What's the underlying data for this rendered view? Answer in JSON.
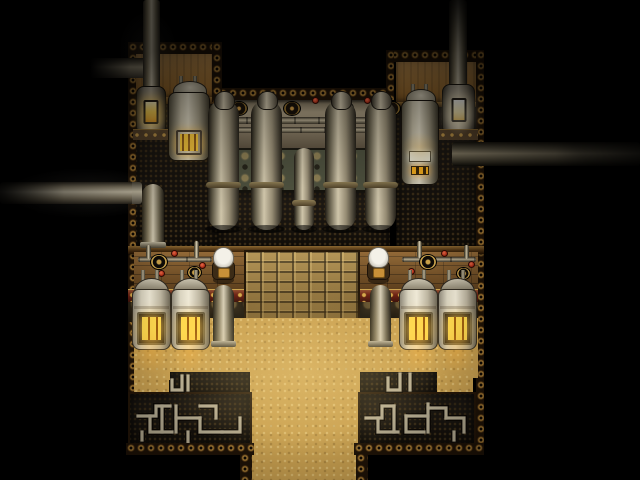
{
  "viewport": {
    "width": 640,
    "height": 480,
    "visible_text": "none"
  },
  "palette": {
    "black": "#000000",
    "sand": "#c9a050",
    "tan": "#b08040",
    "rivetBg": "#1f1307",
    "rivetAu": "#c09040",
    "mesh": "#15100a",
    "meshDot": "#3c2e18",
    "red": "#6e2114",
    "ornateG": "#4c4f3d",
    "ornateGHi": "#8a7c52",
    "bronze": "#352b1b",
    "bronzeHi": "#6a5733",
    "plank": "#7d5527",
    "crate": "#a08044",
    "amber": "#ffcf3a"
  },
  "scene": {
    "entities": [
      {
        "id": "rivet-top-left-block",
        "type": "rivets",
        "x": 128,
        "y": 42,
        "w": 94,
        "h": 12,
        "interactable": false
      },
      {
        "id": "wall-left-block",
        "type": "tanwall",
        "x": 134,
        "y": 54,
        "w": 84,
        "h": 46,
        "interactable": false
      },
      {
        "id": "trim-left-block",
        "type": "trim",
        "x": 134,
        "y": 97,
        "w": 84,
        "h": 7,
        "interactable": false
      },
      {
        "id": "meshfloor-left-block",
        "type": "mesh",
        "x": 134,
        "y": 104,
        "w": 84,
        "h": 148,
        "interactable": false
      },
      {
        "id": "rivet-top-mid-block",
        "type": "rivets",
        "x": 218,
        "y": 88,
        "w": 172,
        "h": 12,
        "interactable": false
      },
      {
        "id": "machine-wall",
        "type": "machinewall",
        "x": 218,
        "y": 100,
        "w": 172,
        "h": 48,
        "interactable": false
      },
      {
        "id": "ornate-band-green",
        "type": "ornateG",
        "x": 218,
        "y": 148,
        "w": 172,
        "h": 44,
        "interactable": false
      },
      {
        "id": "meshfloor-mid-block",
        "type": "mesh",
        "x": 218,
        "y": 192,
        "w": 172,
        "h": 60,
        "interactable": false
      },
      {
        "id": "rivet-top-right-block",
        "type": "rivets",
        "x": 390,
        "y": 50,
        "w": 94,
        "h": 12,
        "interactable": false
      },
      {
        "id": "wall-right-block",
        "type": "tanwall",
        "x": 396,
        "y": 62,
        "w": 82,
        "h": 42,
        "interactable": false
      },
      {
        "id": "trim-right-block",
        "type": "trim",
        "x": 396,
        "y": 102,
        "w": 82,
        "h": 5,
        "interactable": false
      },
      {
        "id": "meshfloor-right-block",
        "type": "mesh",
        "x": 396,
        "y": 107,
        "w": 82,
        "h": 145,
        "interactable": false
      },
      {
        "id": "rivet-col-left-wall",
        "type": "rivets",
        "x": 128,
        "y": 42,
        "w": 8,
        "h": 413,
        "interactable": false
      },
      {
        "id": "rivet-col-right-wall",
        "type": "rivets",
        "x": 476,
        "y": 50,
        "w": 8,
        "h": 405,
        "interactable": false
      },
      {
        "id": "rivet-col-notch-left",
        "type": "rivets",
        "x": 212,
        "y": 42,
        "w": 10,
        "h": 60,
        "interactable": false
      },
      {
        "id": "rivet-col-notch-right",
        "type": "rivets",
        "x": 386,
        "y": 50,
        "w": 8,
        "h": 50,
        "interactable": false
      },
      {
        "id": "beam-middle",
        "type": "beam",
        "x": 128,
        "y": 246,
        "w": 356,
        "h": 8,
        "interactable": false
      },
      {
        "id": "plank-floor-left",
        "type": "plank",
        "x": 134,
        "y": 252,
        "w": 110,
        "h": 40,
        "interactable": false
      },
      {
        "id": "plank-floor-right",
        "type": "plank",
        "x": 360,
        "y": 252,
        "w": 118,
        "h": 40,
        "interactable": false
      },
      {
        "id": "crate-grid",
        "type": "crate",
        "x": 244,
        "y": 250,
        "w": 116,
        "h": 73,
        "interactable": false
      },
      {
        "id": "ornate-band-red-left",
        "type": "bandRed",
        "x": 128,
        "y": 289,
        "w": 116,
        "h": 14,
        "interactable": false
      },
      {
        "id": "ornate-band-red-right",
        "type": "bandRed",
        "x": 360,
        "y": 289,
        "w": 118,
        "h": 14,
        "interactable": false
      },
      {
        "id": "ornate-band-bronze-left",
        "type": "bandBronze",
        "x": 128,
        "y": 302,
        "w": 116,
        "h": 20,
        "interactable": false
      },
      {
        "id": "ornate-band-bronze-right",
        "type": "bandBronze",
        "x": 360,
        "y": 302,
        "w": 118,
        "h": 20,
        "interactable": false
      },
      {
        "id": "sand-floor-main",
        "type": "sand",
        "x": 134,
        "y": 318,
        "w": 344,
        "h": 60,
        "interactable": true
      },
      {
        "id": "sand-corridor-bottom",
        "type": "sand",
        "x": 248,
        "y": 375,
        "w": 112,
        "h": 105,
        "interactable": true
      },
      {
        "id": "sand-inset-left",
        "type": "sand",
        "x": 134,
        "y": 375,
        "w": 37,
        "h": 25,
        "interactable": true
      },
      {
        "id": "sand-inset-right",
        "type": "sand",
        "x": 437,
        "y": 375,
        "w": 36,
        "h": 25,
        "interactable": true
      },
      {
        "id": "pipe-maze-left-upper",
        "type": "mesh",
        "x": 170,
        "y": 372,
        "w": 80,
        "h": 22,
        "interactable": false
      },
      {
        "id": "pipe-maze-right-upper",
        "type": "mesh",
        "x": 360,
        "y": 372,
        "w": 77,
        "h": 22,
        "interactable": false
      },
      {
        "id": "pipe-maze-left",
        "type": "maze",
        "x": 128,
        "y": 392,
        "w": 124,
        "h": 60,
        "interactable": false,
        "paths": [
          "M10,24 h18 v-10 h14",
          "M22,24 v16 h22",
          "M34,40 v-26",
          "M48,14 v26",
          "M48,26 h24",
          "M72,26 v14 h22",
          "M72,14 h16 v12",
          "M94,40 h18 v-14",
          "M60,40 v10",
          "M14,40 v8",
          "M44,-12 v10 h10 v-14",
          "M60,-16 v14"
        ]
      },
      {
        "id": "pipe-maze-right",
        "type": "maze",
        "x": 358,
        "y": 392,
        "w": 118,
        "h": 60,
        "interactable": false,
        "paths": [
          "M8,26 h16 v-12 h12",
          "M20,26 v14 h20",
          "M36,14 v26",
          "M48,24 h22",
          "M48,24 v16 h18",
          "M70,12 v28",
          "M70,16 h18 v10",
          "M88,26 h18 v14",
          "M96,40 v8",
          "M30,-14 v12 h12 v-16",
          "M52,-18 v16"
        ]
      },
      {
        "id": "rivet-row-bottom-left",
        "type": "rivets",
        "x": 126,
        "y": 443,
        "w": 128,
        "h": 12,
        "interactable": false
      },
      {
        "id": "rivet-row-bottom-right",
        "type": "rivets",
        "x": 354,
        "y": 443,
        "w": 130,
        "h": 12,
        "interactable": false
      },
      {
        "id": "rivet-col-corridor-left",
        "type": "rivets",
        "x": 240,
        "y": 453,
        "w": 12,
        "h": 27,
        "interactable": false
      },
      {
        "id": "rivet-col-corridor-right",
        "type": "rivets",
        "x": 356,
        "y": 453,
        "w": 12,
        "h": 27,
        "interactable": false
      },
      {
        "id": "steam-pipe-stub-top-left",
        "type": "pipeV",
        "variant": "stub-left",
        "x": 90,
        "y": 58,
        "w": 58,
        "h": 20,
        "interactable": false
      },
      {
        "id": "steam-pipe-vertical-top-left",
        "type": "pipeV",
        "x": 143,
        "y": 0,
        "w": 17,
        "h": 96,
        "interactable": false
      },
      {
        "id": "chimney-top-right",
        "type": "pipeV",
        "variant": "fade-top",
        "x": 449,
        "y": 0,
        "w": 18,
        "h": 98,
        "interactable": false
      },
      {
        "id": "steam-pipe-exterior-left",
        "type": "pipeH",
        "variant": "ext-left",
        "x": 0,
        "y": 182,
        "w": 142,
        "h": 22,
        "interactable": false
      },
      {
        "id": "steam-pipe-exterior-right",
        "type": "pipeH",
        "variant": "ext-right",
        "x": 452,
        "y": 142,
        "w": 188,
        "h": 24,
        "interactable": false
      },
      {
        "id": "furnace-top-left",
        "type": "furnace",
        "variant": "amber",
        "x": 136,
        "y": 86,
        "w": 30,
        "h": 54,
        "interactable": true
      },
      {
        "id": "tank-top-left",
        "type": "tank",
        "variant": "bars",
        "x": 168,
        "y": 76,
        "w": 42,
        "h": 88,
        "interactable": true
      },
      {
        "id": "capsule-under-tank-left",
        "type": "capsule",
        "x": 142,
        "y": 184,
        "w": 22,
        "h": 64,
        "interactable": false
      },
      {
        "id": "pipe-rail-upper",
        "type": "rail",
        "x": 222,
        "y": 117,
        "w": 164,
        "h": 7,
        "interactable": false
      },
      {
        "id": "pipe-rail-lower",
        "type": "rail",
        "x": 228,
        "y": 127,
        "w": 158,
        "h": 6,
        "interactable": false
      },
      {
        "id": "gauge-1",
        "type": "gauge",
        "x": 230,
        "y": 101,
        "w": 18,
        "h": 15,
        "interactable": true
      },
      {
        "id": "gauge-2",
        "type": "gauge",
        "x": 283,
        "y": 101,
        "w": 18,
        "h": 15,
        "interactable": true
      },
      {
        "id": "gauge-3",
        "type": "gauge",
        "x": 336,
        "y": 101,
        "w": 18,
        "h": 15,
        "interactable": true
      },
      {
        "id": "gauge-4",
        "type": "gauge",
        "x": 383,
        "y": 101,
        "w": 18,
        "h": 15,
        "interactable": true
      },
      {
        "id": "valve-wall-1",
        "type": "valve",
        "x": 259,
        "y": 97,
        "w": 7,
        "h": 7,
        "interactable": true
      },
      {
        "id": "valve-wall-2",
        "type": "valve",
        "x": 312,
        "y": 97,
        "w": 7,
        "h": 7,
        "interactable": true
      },
      {
        "id": "valve-wall-3",
        "type": "valve",
        "x": 364,
        "y": 97,
        "w": 7,
        "h": 7,
        "interactable": true
      },
      {
        "id": "valve-wall-4",
        "type": "valve",
        "x": 268,
        "y": 126,
        "w": 7,
        "h": 7,
        "interactable": true
      },
      {
        "id": "valve-wall-5",
        "type": "valve",
        "x": 340,
        "y": 126,
        "w": 7,
        "h": 7,
        "interactable": true
      },
      {
        "id": "distill-column-1",
        "type": "column",
        "x": 208,
        "y": 100,
        "w": 31,
        "h": 130,
        "interactable": false
      },
      {
        "id": "distill-column-2",
        "type": "column",
        "x": 251,
        "y": 100,
        "w": 31,
        "h": 130,
        "interactable": false
      },
      {
        "id": "distill-column-short",
        "type": "column",
        "variant": "short",
        "x": 294,
        "y": 148,
        "w": 20,
        "h": 82,
        "interactable": false
      },
      {
        "id": "distill-column-3",
        "type": "column",
        "x": 325,
        "y": 100,
        "w": 31,
        "h": 130,
        "interactable": false
      },
      {
        "id": "distill-column-4",
        "type": "column",
        "x": 365,
        "y": 100,
        "w": 31,
        "h": 130,
        "interactable": false
      },
      {
        "id": "furnace-top-right",
        "type": "furnace",
        "variant": "white",
        "x": 442,
        "y": 84,
        "w": 33,
        "h": 56,
        "interactable": true
      },
      {
        "id": "tank-top-right",
        "type": "tank",
        "variant": "gauge",
        "x": 401,
        "y": 84,
        "w": 38,
        "h": 104,
        "interactable": true
      },
      {
        "id": "bench-pipe-left-h",
        "type": "rail",
        "x": 138,
        "y": 257,
        "w": 74,
        "h": 5,
        "interactable": false
      },
      {
        "id": "bench-pipe-left-v1",
        "type": "pipeV",
        "x": 146,
        "y": 245,
        "w": 5,
        "h": 14,
        "interactable": false
      },
      {
        "id": "bench-pipe-left-v2",
        "type": "pipeV",
        "x": 194,
        "y": 241,
        "w": 5,
        "h": 17,
        "interactable": false
      },
      {
        "id": "burner-left-1",
        "type": "burner",
        "x": 150,
        "y": 254,
        "w": 18,
        "h": 16,
        "interactable": true
      },
      {
        "id": "burner-left-2",
        "type": "burner",
        "x": 187,
        "y": 266,
        "w": 15,
        "h": 13,
        "interactable": true
      },
      {
        "id": "valve-bench-left-1",
        "type": "valve",
        "x": 171,
        "y": 250,
        "w": 7,
        "h": 7,
        "interactable": true
      },
      {
        "id": "valve-bench-left-2",
        "type": "valve",
        "x": 158,
        "y": 270,
        "w": 7,
        "h": 7,
        "interactable": true
      },
      {
        "id": "valve-bench-left-3",
        "type": "valve",
        "x": 199,
        "y": 262,
        "w": 7,
        "h": 7,
        "interactable": true
      },
      {
        "id": "bench-pipe-right-h",
        "type": "rail",
        "x": 402,
        "y": 257,
        "w": 74,
        "h": 5,
        "interactable": false
      },
      {
        "id": "bench-pipe-right-v1",
        "type": "pipeV",
        "x": 464,
        "y": 245,
        "w": 5,
        "h": 14,
        "interactable": false
      },
      {
        "id": "bench-pipe-right-v2",
        "type": "pipeV",
        "x": 417,
        "y": 241,
        "w": 5,
        "h": 17,
        "interactable": false
      },
      {
        "id": "burner-right-1",
        "type": "burner",
        "x": 419,
        "y": 254,
        "w": 18,
        "h": 16,
        "interactable": true
      },
      {
        "id": "burner-right-2",
        "type": "burner",
        "x": 456,
        "y": 267,
        "w": 15,
        "h": 13,
        "interactable": true
      },
      {
        "id": "valve-bench-right-1",
        "type": "valve",
        "x": 441,
        "y": 250,
        "w": 7,
        "h": 7,
        "interactable": true
      },
      {
        "id": "valve-bench-right-2",
        "type": "valve",
        "x": 408,
        "y": 268,
        "w": 7,
        "h": 7,
        "interactable": true
      },
      {
        "id": "valve-bench-right-3",
        "type": "valve",
        "x": 468,
        "y": 261,
        "w": 7,
        "h": 7,
        "interactable": true
      },
      {
        "id": "boiler-1",
        "type": "boiler",
        "x": 132,
        "y": 270,
        "w": 39,
        "h": 82,
        "interactable": true
      },
      {
        "id": "boiler-2",
        "type": "boiler",
        "x": 171,
        "y": 270,
        "w": 39,
        "h": 82,
        "interactable": true
      },
      {
        "id": "boiler-3",
        "type": "boiler",
        "x": 399,
        "y": 270,
        "w": 39,
        "h": 82,
        "interactable": true
      },
      {
        "id": "boiler-4",
        "type": "boiler",
        "x": 438,
        "y": 270,
        "w": 39,
        "h": 82,
        "interactable": true
      },
      {
        "id": "floor-pipe-left",
        "type": "capsule",
        "x": 213,
        "y": 285,
        "w": 21,
        "h": 62,
        "interactable": false
      },
      {
        "id": "floor-pipe-right",
        "type": "capsule",
        "x": 370,
        "y": 285,
        "w": 21,
        "h": 62,
        "interactable": false
      },
      {
        "id": "npc-worker-left",
        "type": "npc",
        "x": 210,
        "y": 247,
        "w": 27,
        "h": 37,
        "interactable": true
      },
      {
        "id": "npc-worker-right",
        "type": "npc",
        "x": 365,
        "y": 247,
        "w": 27,
        "h": 37,
        "interactable": true
      },
      {
        "id": "glow-center-floor",
        "type": "glow",
        "x": 160,
        "y": 295,
        "w": 290,
        "h": 165,
        "color": "rgba(255,220,140,0.20)",
        "interactable": false
      },
      {
        "id": "glow-boiler-1",
        "type": "glow",
        "x": 133,
        "y": 330,
        "w": 36,
        "h": 44,
        "color": "rgba(255,180,60,0.35)",
        "interactable": false
      },
      {
        "id": "glow-boiler-2",
        "type": "glow",
        "x": 172,
        "y": 330,
        "w": 36,
        "h": 44,
        "color": "rgba(255,180,60,0.35)",
        "interactable": false
      },
      {
        "id": "glow-boiler-3",
        "type": "glow",
        "x": 400,
        "y": 330,
        "w": 36,
        "h": 44,
        "color": "rgba(255,180,60,0.35)",
        "interactable": false
      },
      {
        "id": "glow-boiler-4",
        "type": "glow",
        "x": 439,
        "y": 330,
        "w": 36,
        "h": 44,
        "color": "rgba(255,180,60,0.35)",
        "interactable": false
      },
      {
        "id": "glow-furnace-left",
        "type": "glow",
        "x": 138,
        "y": 98,
        "w": 28,
        "h": 38,
        "color": "rgba(255,220,120,0.30)",
        "interactable": false
      },
      {
        "id": "glow-furnace-right",
        "type": "glow",
        "x": 444,
        "y": 96,
        "w": 30,
        "h": 40,
        "color": "rgba(255,245,210,0.35)",
        "interactable": false
      },
      {
        "id": "glow-tank-left",
        "type": "glow",
        "x": 170,
        "y": 128,
        "w": 38,
        "h": 32,
        "color": "rgba(255,190,70,0.30)",
        "interactable": false
      },
      {
        "id": "glow-tank-right",
        "type": "glow",
        "x": 402,
        "y": 132,
        "w": 36,
        "h": 30,
        "color": "rgba(255,190,70,0.30)",
        "interactable": false
      },
      {
        "id": "glow-pipe-exterior-left",
        "type": "glow",
        "x": 5,
        "y": 168,
        "w": 160,
        "h": 50,
        "color": "rgba(210,200,180,0.14)",
        "interactable": false
      },
      {
        "id": "glow-pipe-top-left",
        "type": "glow",
        "x": 118,
        "y": 10,
        "w": 60,
        "h": 80,
        "color": "rgba(200,190,170,0.10)",
        "interactable": false
      },
      {
        "id": "vignette-overlay",
        "type": "vignette",
        "x": 0,
        "y": 0,
        "w": 640,
        "h": 480,
        "interactable": false
      }
    ]
  }
}
